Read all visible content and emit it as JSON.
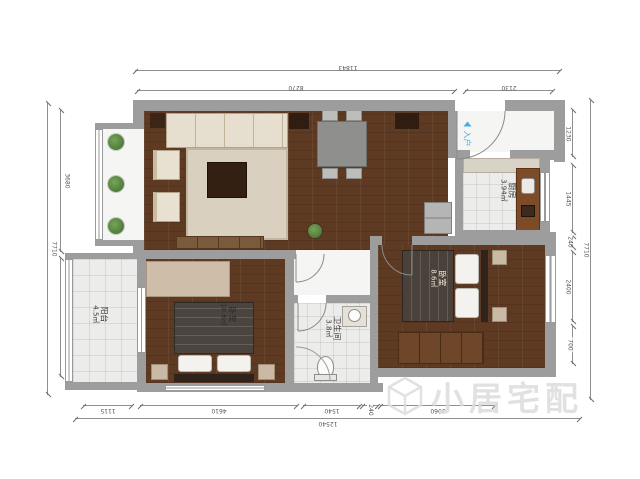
{
  "watermark": {
    "text": "小居宅配"
  },
  "rooms": {
    "balcony": {
      "name": "阳台",
      "area": "4.5㎡"
    },
    "bedroom_main": {
      "name": "卧室",
      "area": "10.6㎡"
    },
    "bathroom": {
      "name": "卫生间",
      "area": "3.8㎡"
    },
    "bedroom_second": {
      "name": "卧室",
      "area": "8.6㎡"
    },
    "kitchen": {
      "name": "厨房",
      "area": "3.94㎡"
    },
    "entry_label": "入户"
  },
  "dimensions": {
    "top": {
      "total": "11843",
      "segments": [
        "8270",
        "2130"
      ]
    },
    "bottom": {
      "total": "12540",
      "segments": [
        "1115",
        "4610",
        "1540",
        "240",
        "3060"
      ]
    },
    "left": {
      "total": "7710",
      "segments": [
        "3680",
        "3340"
      ]
    },
    "right": {
      "total": "7710",
      "segments": [
        "1230",
        "1445",
        "240",
        "2400",
        "700"
      ]
    }
  },
  "colors": {
    "wall": "#9d9d9d",
    "wood_floor": "#5e3a23",
    "entry_accent": "#3fb1e3",
    "watermark": "#dcdcdc"
  }
}
